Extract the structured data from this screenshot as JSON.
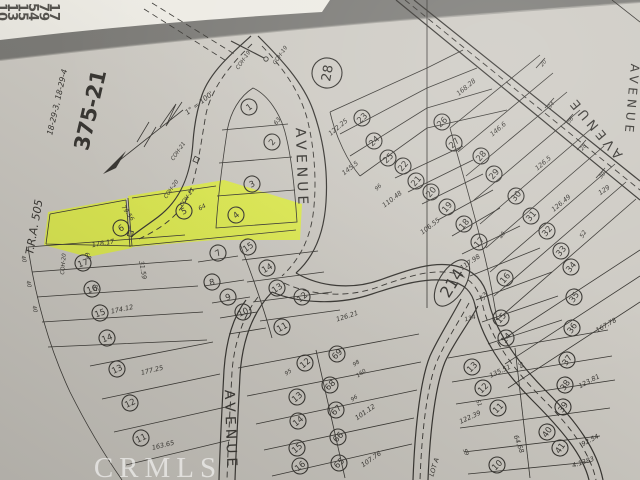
{
  "photo": {
    "background_color": "#7b7a76",
    "paper_color": "#cdcac3",
    "paper_light": "#dbd8d1",
    "paper_dark": "#aeaba4",
    "ink_color": "#35332f",
    "strip_color": "#edebe4",
    "highlight_color": "#e4f62e",
    "index_tabs": [
      "10",
      "13",
      "15",
      "54",
      "79",
      "17"
    ],
    "watermark": "CRMLS"
  },
  "map": {
    "sheet_number": "375-21",
    "sheet_code": "18-29-3, 18-29-4",
    "tra": "T.R.A. 505",
    "scale": "1\" = 100'",
    "block_circle": "28",
    "block_oval": "214",
    "street": "AVENUE",
    "highlighted_lots": [
      "5",
      "6"
    ],
    "labels": [
      {
        "t": "18-29-3, 18-29-4",
        "x": 57,
        "y": 102,
        "r": -77,
        "s": 8
      },
      {
        "t": "375-21",
        "x": 90,
        "y": 110,
        "r": -77,
        "s": 21,
        "k": "t"
      },
      {
        "t": "T.R.A. 505",
        "x": 34,
        "y": 227,
        "r": -80,
        "s": 11
      },
      {
        "t": "1\" = 100'",
        "x": 199,
        "y": 103,
        "r": -38,
        "s": 7
      },
      {
        "t": "COH-19",
        "x": 243,
        "y": 60,
        "r": -55,
        "s": 5.5
      },
      {
        "t": "COH-19",
        "x": 280,
        "y": 55,
        "r": -55,
        "s": 5.5
      },
      {
        "t": "COH-21",
        "x": 178,
        "y": 151,
        "r": -55,
        "s": 5.5
      },
      {
        "t": "COH-20",
        "x": 171,
        "y": 189,
        "r": -55,
        "s": 5.5
      },
      {
        "t": "COH-21",
        "x": 187,
        "y": 197,
        "r": -55,
        "s": 5.5
      },
      {
        "t": "COH-20",
        "x": 63,
        "y": 264,
        "r": -85,
        "s": 5.5
      },
      {
        "t": "LOT A",
        "x": 434,
        "y": 467,
        "r": -73,
        "s": 6.5
      },
      {
        "t": "AVENUE",
        "x": 302,
        "y": 168,
        "r": 88,
        "s": 14,
        "k": "s"
      },
      {
        "t": "AVENUE",
        "x": 231,
        "y": 430,
        "r": 88,
        "s": 14,
        "k": "s"
      },
      {
        "t": "AVENUE",
        "x": 595,
        "y": 128,
        "r": -130,
        "s": 13,
        "k": "s"
      },
      {
        "t": "AVENUE",
        "x": 632,
        "y": 100,
        "r": 95,
        "s": 12,
        "k": "s"
      },
      {
        "t": "28",
        "x": 327,
        "y": 73,
        "r": -80,
        "s": 13,
        "k": "C"
      },
      {
        "t": "214",
        "x": 452,
        "y": 283,
        "r": -58,
        "s": 16,
        "k": "o"
      },
      {
        "t": "1",
        "x": 249,
        "y": 107,
        "r": -35,
        "k": "c"
      },
      {
        "t": "2",
        "x": 272,
        "y": 142,
        "r": -50,
        "k": "c"
      },
      {
        "t": "3",
        "x": 252,
        "y": 184,
        "r": -25,
        "k": "c"
      },
      {
        "t": "4",
        "x": 236,
        "y": 215,
        "r": -40,
        "k": "c"
      },
      {
        "t": "5",
        "x": 184,
        "y": 211,
        "r": -25,
        "k": "c"
      },
      {
        "t": "6",
        "x": 121,
        "y": 228,
        "r": -30,
        "k": "c"
      },
      {
        "t": "7",
        "x": 218,
        "y": 253,
        "r": -30,
        "k": "c"
      },
      {
        "t": "8",
        "x": 212,
        "y": 282,
        "r": -15,
        "k": "c"
      },
      {
        "t": "9",
        "x": 228,
        "y": 297,
        "r": -20,
        "k": "c"
      },
      {
        "t": "10",
        "x": 243,
        "y": 312,
        "r": -25,
        "k": "c"
      },
      {
        "t": "11",
        "x": 282,
        "y": 327,
        "r": -30,
        "k": "c"
      },
      {
        "t": "15",
        "x": 248,
        "y": 247,
        "r": -35,
        "k": "c"
      },
      {
        "t": "14",
        "x": 267,
        "y": 268,
        "r": -30,
        "k": "c"
      },
      {
        "t": "13",
        "x": 277,
        "y": 288,
        "r": -35,
        "k": "c"
      },
      {
        "t": "12",
        "x": 302,
        "y": 297,
        "r": -40,
        "k": "c"
      },
      {
        "t": "17",
        "x": 83,
        "y": 263,
        "r": -20,
        "k": "c"
      },
      {
        "t": "16",
        "x": 92,
        "y": 289,
        "r": -20,
        "k": "c"
      },
      {
        "t": "15",
        "x": 100,
        "y": 313,
        "r": -20,
        "k": "c"
      },
      {
        "t": "14",
        "x": 107,
        "y": 338,
        "r": -20,
        "k": "c"
      },
      {
        "t": "13",
        "x": 117,
        "y": 369,
        "r": -25,
        "k": "c"
      },
      {
        "t": "12",
        "x": 130,
        "y": 403,
        "r": -25,
        "k": "c"
      },
      {
        "t": "11",
        "x": 141,
        "y": 438,
        "r": -25,
        "k": "c"
      },
      {
        "t": "23",
        "x": 362,
        "y": 118,
        "r": -45,
        "k": "c"
      },
      {
        "t": "24",
        "x": 374,
        "y": 141,
        "r": -45,
        "k": "c"
      },
      {
        "t": "25",
        "x": 388,
        "y": 158,
        "r": -45,
        "k": "c"
      },
      {
        "t": "26",
        "x": 442,
        "y": 122,
        "r": -45,
        "k": "c"
      },
      {
        "t": "27",
        "x": 454,
        "y": 143,
        "r": -45,
        "k": "c"
      },
      {
        "t": "22",
        "x": 403,
        "y": 166,
        "r": -50,
        "k": "c"
      },
      {
        "t": "21",
        "x": 416,
        "y": 181,
        "r": -50,
        "k": "c"
      },
      {
        "t": "20",
        "x": 431,
        "y": 192,
        "r": -50,
        "k": "c"
      },
      {
        "t": "19",
        "x": 447,
        "y": 207,
        "r": -50,
        "k": "c"
      },
      {
        "t": "18",
        "x": 464,
        "y": 224,
        "r": -50,
        "k": "c"
      },
      {
        "t": "17",
        "x": 479,
        "y": 242,
        "r": -50,
        "k": "c"
      },
      {
        "t": "16",
        "x": 505,
        "y": 278,
        "r": -50,
        "k": "c"
      },
      {
        "t": "15",
        "x": 501,
        "y": 318,
        "r": -50,
        "k": "c"
      },
      {
        "t": "14",
        "x": 506,
        "y": 338,
        "r": -50,
        "k": "c"
      },
      {
        "t": "28",
        "x": 481,
        "y": 156,
        "r": -50,
        "k": "c"
      },
      {
        "t": "29",
        "x": 494,
        "y": 174,
        "r": -50,
        "k": "c"
      },
      {
        "t": "30",
        "x": 516,
        "y": 196,
        "r": -50,
        "k": "c"
      },
      {
        "t": "31",
        "x": 531,
        "y": 216,
        "r": -50,
        "k": "c"
      },
      {
        "t": "32",
        "x": 547,
        "y": 231,
        "r": -50,
        "k": "c"
      },
      {
        "t": "33",
        "x": 561,
        "y": 251,
        "r": -50,
        "k": "c"
      },
      {
        "t": "34",
        "x": 571,
        "y": 267,
        "r": -50,
        "k": "c"
      },
      {
        "t": "35",
        "x": 574,
        "y": 297,
        "r": -55,
        "k": "c"
      },
      {
        "t": "36",
        "x": 572,
        "y": 328,
        "r": -55,
        "k": "c"
      },
      {
        "t": "37",
        "x": 567,
        "y": 360,
        "r": -55,
        "k": "c"
      },
      {
        "t": "38",
        "x": 565,
        "y": 385,
        "r": -55,
        "k": "c"
      },
      {
        "t": "39",
        "x": 563,
        "y": 407,
        "r": -55,
        "k": "c"
      },
      {
        "t": "40",
        "x": 547,
        "y": 432,
        "r": -55,
        "k": "c"
      },
      {
        "t": "41",
        "x": 560,
        "y": 448,
        "r": -55,
        "k": "c"
      },
      {
        "t": "12",
        "x": 305,
        "y": 363,
        "r": -40,
        "k": "c"
      },
      {
        "t": "13",
        "x": 297,
        "y": 397,
        "r": -40,
        "k": "c"
      },
      {
        "t": "14",
        "x": 298,
        "y": 421,
        "r": -40,
        "k": "c"
      },
      {
        "t": "15",
        "x": 297,
        "y": 448,
        "r": -40,
        "k": "c"
      },
      {
        "t": "16",
        "x": 300,
        "y": 466,
        "r": -40,
        "k": "c"
      },
      {
        "t": "69",
        "x": 337,
        "y": 354,
        "r": -45,
        "k": "c"
      },
      {
        "t": "68",
        "x": 330,
        "y": 385,
        "r": -45,
        "k": "c"
      },
      {
        "t": "67",
        "x": 336,
        "y": 410,
        "r": -45,
        "k": "c"
      },
      {
        "t": "66",
        "x": 338,
        "y": 437,
        "r": -45,
        "k": "c"
      },
      {
        "t": "65",
        "x": 339,
        "y": 463,
        "r": -45,
        "k": "c"
      },
      {
        "t": "13",
        "x": 472,
        "y": 367,
        "r": -45,
        "k": "c"
      },
      {
        "t": "12",
        "x": 483,
        "y": 388,
        "r": -45,
        "k": "c"
      },
      {
        "t": "11",
        "x": 498,
        "y": 408,
        "r": -45,
        "k": "c"
      },
      {
        "t": "10",
        "x": 497,
        "y": 465,
        "r": -45,
        "k": "c"
      },
      {
        "t": "178.17",
        "x": 103,
        "y": 243,
        "r": -10
      },
      {
        "t": "174.12",
        "x": 122,
        "y": 309,
        "r": -12
      },
      {
        "t": "31.59",
        "x": 143,
        "y": 270,
        "r": 80
      },
      {
        "t": "177.25",
        "x": 152,
        "y": 370,
        "r": -14
      },
      {
        "t": "163.65",
        "x": 163,
        "y": 445,
        "r": -14
      },
      {
        "t": "40",
        "x": 24,
        "y": 259,
        "r": 78,
        "s": 5.5
      },
      {
        "t": "40",
        "x": 29,
        "y": 284,
        "r": 78,
        "s": 5.5
      },
      {
        "t": "40",
        "x": 35,
        "y": 309,
        "r": 78,
        "s": 5.5
      },
      {
        "t": "85",
        "x": 96,
        "y": 288,
        "r": 75,
        "s": 5.5
      },
      {
        "t": "79.56",
        "x": 128,
        "y": 213,
        "r": 55,
        "s": 6
      },
      {
        "t": "64",
        "x": 202,
        "y": 207,
        "r": -30,
        "s": 6
      },
      {
        "t": "60",
        "x": 88,
        "y": 256,
        "r": 60,
        "s": 6
      },
      {
        "t": "63",
        "x": 277,
        "y": 121,
        "r": -55,
        "s": 6
      },
      {
        "t": "122.25",
        "x": 338,
        "y": 127,
        "r": -40
      },
      {
        "t": "145.5",
        "x": 350,
        "y": 168,
        "r": -38
      },
      {
        "t": "96",
        "x": 378,
        "y": 187,
        "r": -45,
        "s": 5.5
      },
      {
        "t": "110.48",
        "x": 392,
        "y": 199,
        "r": -38
      },
      {
        "t": "106.55",
        "x": 430,
        "y": 226,
        "r": -38
      },
      {
        "t": "168.28",
        "x": 466,
        "y": 87,
        "r": -40
      },
      {
        "t": "146.6",
        "x": 498,
        "y": 129,
        "r": -40
      },
      {
        "t": "126.5",
        "x": 543,
        "y": 163,
        "r": -40
      },
      {
        "t": "126.49",
        "x": 561,
        "y": 203,
        "r": -40
      },
      {
        "t": "129",
        "x": 604,
        "y": 190,
        "r": -35
      },
      {
        "t": "20",
        "x": 543,
        "y": 63,
        "r": -50,
        "s": 5.5
      },
      {
        "t": "34",
        "x": 551,
        "y": 105,
        "r": -50,
        "s": 5.5
      },
      {
        "t": "56",
        "x": 570,
        "y": 120,
        "r": -50,
        "s": 5.5
      },
      {
        "t": "28",
        "x": 583,
        "y": 147,
        "r": -50,
        "s": 5.5
      },
      {
        "t": "30",
        "x": 602,
        "y": 175,
        "r": -50,
        "s": 5.5
      },
      {
        "t": "52",
        "x": 583,
        "y": 234,
        "r": -60,
        "s": 6
      },
      {
        "t": "117.98",
        "x": 470,
        "y": 262,
        "r": -35
      },
      {
        "t": "53",
        "x": 484,
        "y": 296,
        "r": -60,
        "s": 6
      },
      {
        "t": "134",
        "x": 470,
        "y": 318,
        "r": -15,
        "s": 6
      },
      {
        "t": "40",
        "x": 502,
        "y": 235,
        "r": -60,
        "s": 5.5
      },
      {
        "t": "167.78",
        "x": 606,
        "y": 325,
        "r": -30
      },
      {
        "t": "126.21",
        "x": 347,
        "y": 316,
        "r": -18
      },
      {
        "t": "123.81",
        "x": 589,
        "y": 381,
        "r": -28
      },
      {
        "t": "98",
        "x": 356,
        "y": 363,
        "r": -35,
        "s": 5.5
      },
      {
        "t": "160",
        "x": 361,
        "y": 373,
        "r": -35,
        "s": 5.5
      },
      {
        "t": "96",
        "x": 354,
        "y": 398,
        "r": -35,
        "s": 5.5
      },
      {
        "t": "101.12",
        "x": 365,
        "y": 412,
        "r": -35
      },
      {
        "t": "107.76",
        "x": 371,
        "y": 459,
        "r": -35
      },
      {
        "t": "95",
        "x": 288,
        "y": 372,
        "r": -35,
        "s": 5.5
      },
      {
        "t": "135.51",
        "x": 500,
        "y": 371,
        "r": -25
      },
      {
        "t": "122.39",
        "x": 470,
        "y": 417,
        "r": -25
      },
      {
        "t": "92.54",
        "x": 590,
        "y": 440,
        "r": -28
      },
      {
        "t": "64.68",
        "x": 519,
        "y": 444,
        "r": 70
      },
      {
        "t": "4:1383",
        "x": 583,
        "y": 462,
        "r": -18
      },
      {
        "t": "59",
        "x": 466,
        "y": 452,
        "r": 65,
        "s": 5.5
      },
      {
        "t": "51",
        "x": 479,
        "y": 403,
        "r": 65,
        "s": 5.5
      },
      {
        "t": "54",
        "x": 521,
        "y": 365,
        "r": 65,
        "s": 5.5
      }
    ]
  }
}
